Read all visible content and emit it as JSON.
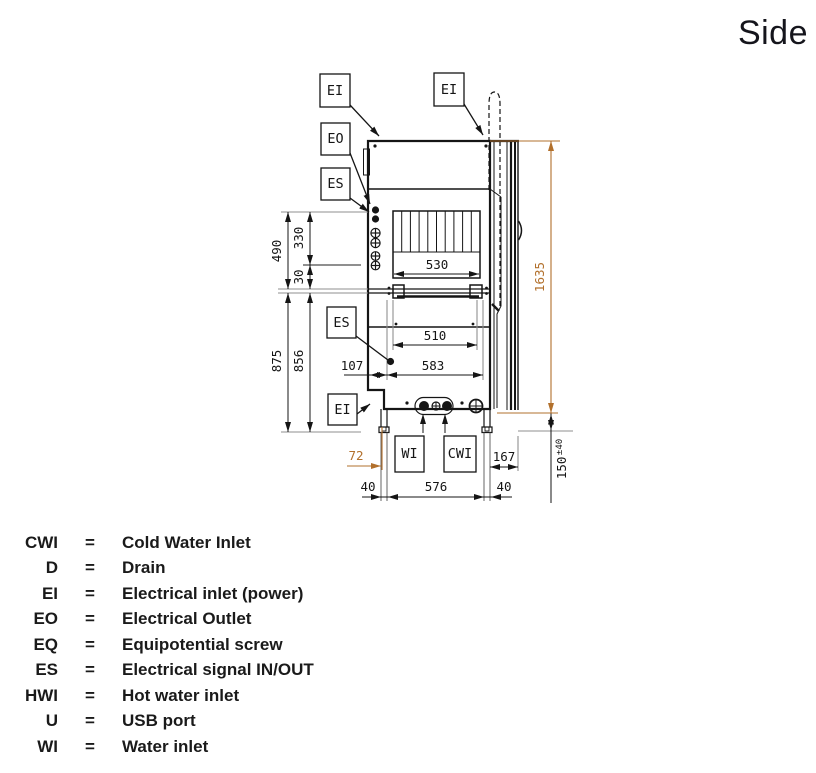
{
  "title": "Side",
  "colors": {
    "line": "#151515",
    "extension_gray": "#8f8f8f",
    "dimension_accent": "#b2702c"
  },
  "labels": {
    "ei": "EI",
    "eo": "EO",
    "es": "ES",
    "wi": "WI",
    "cwi": "CWI"
  },
  "dims": {
    "d490": "490",
    "d330": "330",
    "d30": "30",
    "d875": "875",
    "d856": "856",
    "d530": "530",
    "d510": "510",
    "d583": "583",
    "d107": "107",
    "d1635": "1635",
    "d72": "72",
    "d40_left": "40",
    "d576": "576",
    "d40_right": "40",
    "d167": "167",
    "d150_value": "150",
    "d150_tolerance": "±40"
  },
  "legend": {
    "rows": [
      {
        "abbr": "CWI",
        "eq": "=",
        "desc": "Cold Water Inlet"
      },
      {
        "abbr": "D",
        "eq": "=",
        "desc": "Drain"
      },
      {
        "abbr": "EI",
        "eq": "=",
        "desc": "Electrical inlet (power)"
      },
      {
        "abbr": "EO",
        "eq": "=",
        "desc": "Electrical Outlet"
      },
      {
        "abbr": "EQ",
        "eq": "=",
        "desc": "Equipotential screw"
      },
      {
        "abbr": "ES",
        "eq": "=",
        "desc": "Electrical signal IN/OUT"
      },
      {
        "abbr": "HWI",
        "eq": "=",
        "desc": "Hot water inlet"
      },
      {
        "abbr": "U",
        "eq": "=",
        "desc": "USB port"
      },
      {
        "abbr": "WI",
        "eq": "=",
        "desc": "Water inlet"
      }
    ]
  }
}
